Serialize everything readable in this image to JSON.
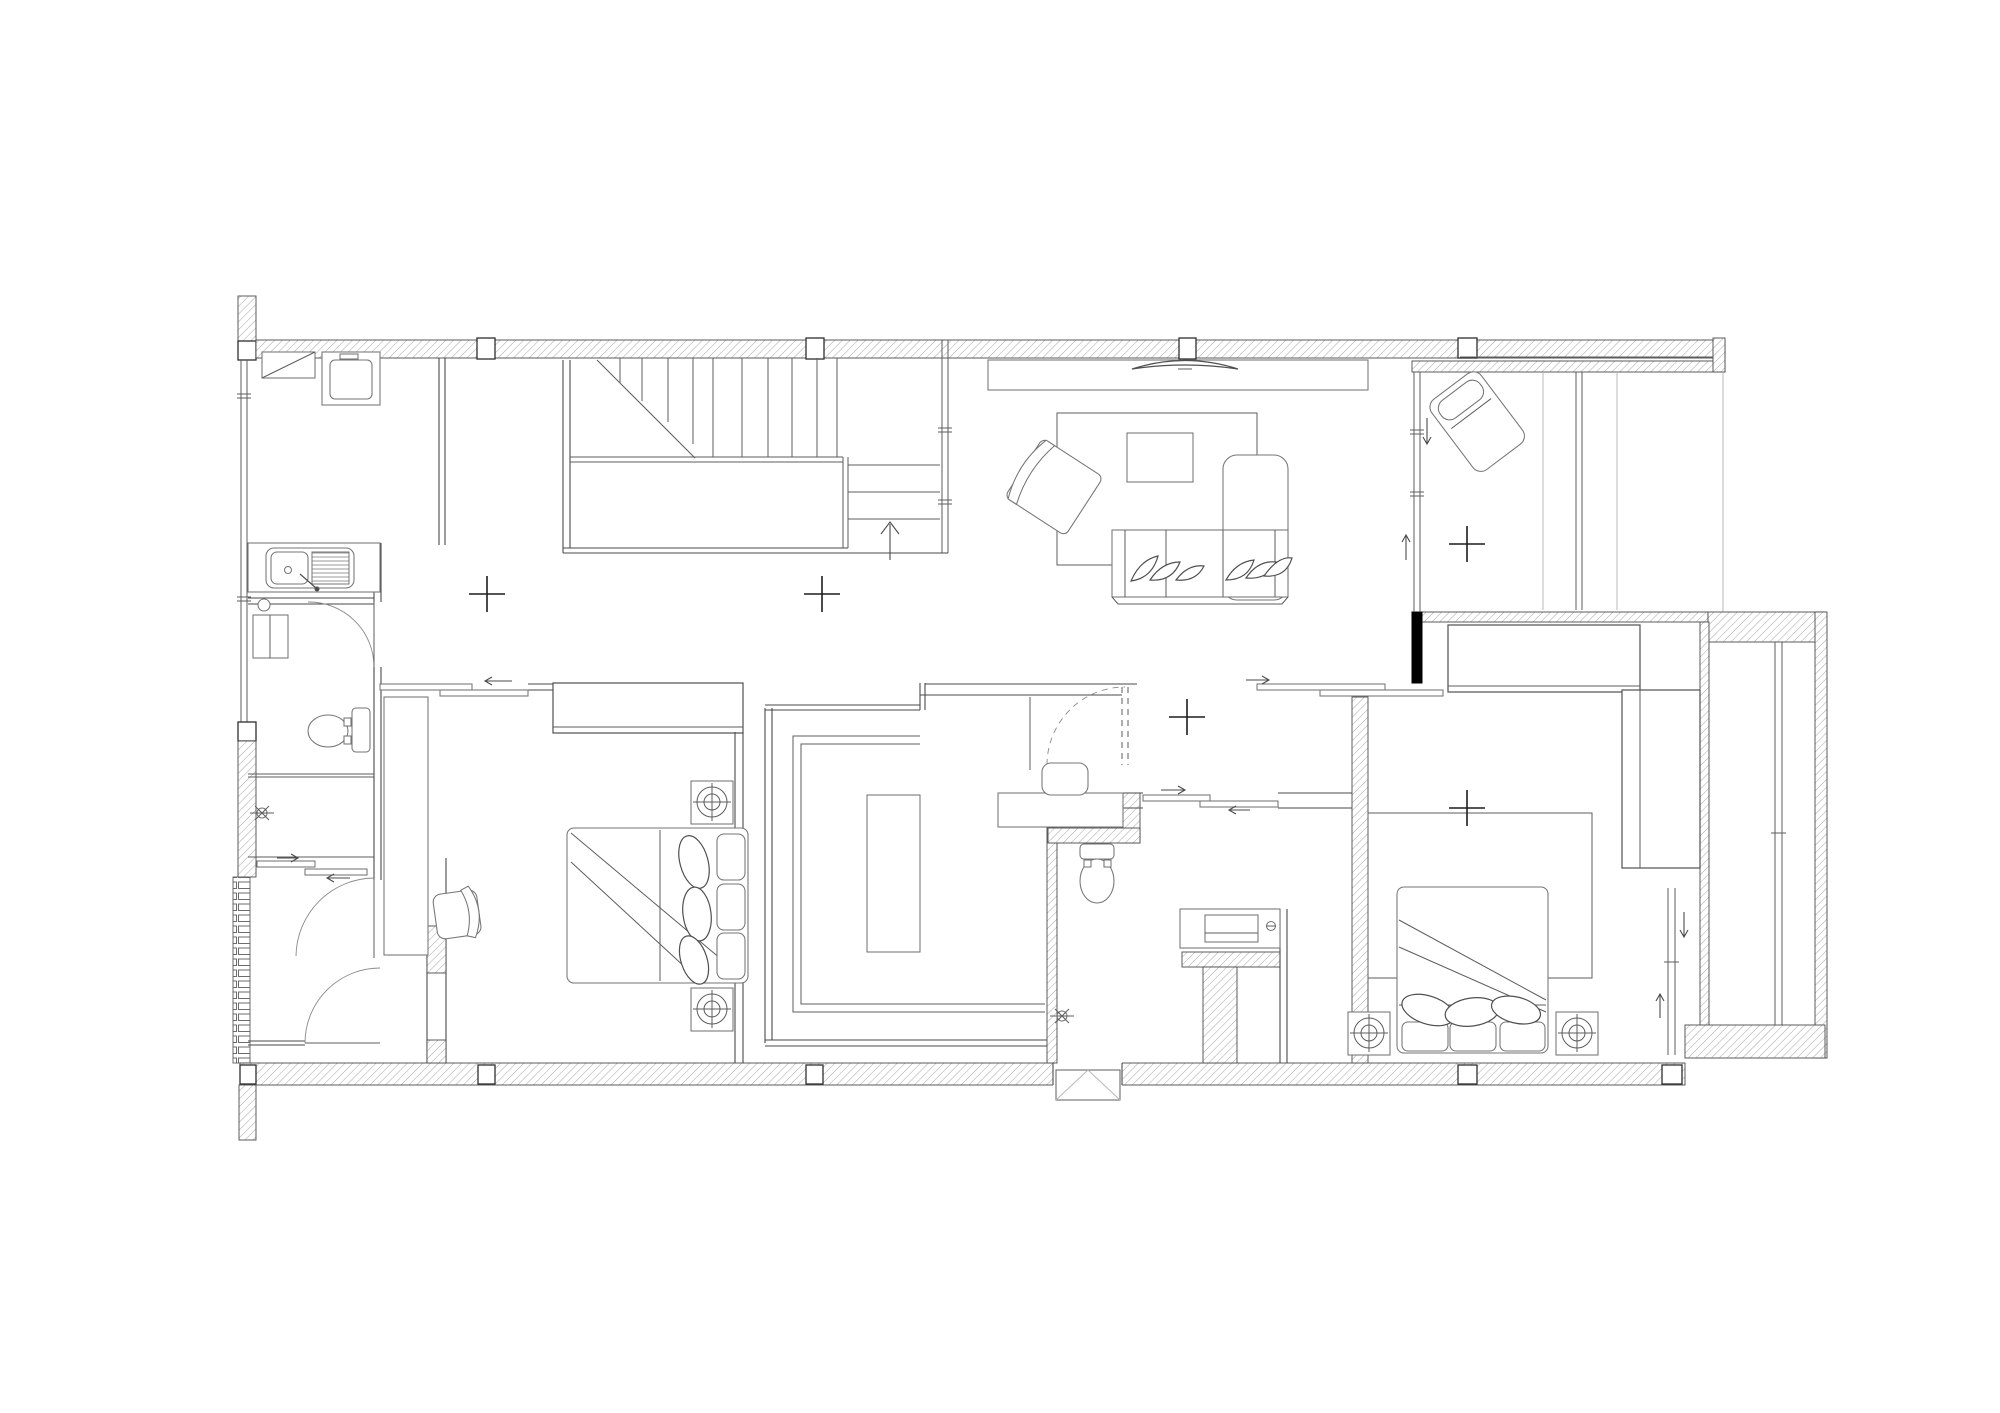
{
  "document": {
    "kind": "architectural-floor-plan",
    "view": "top-down CAD drawing, black lines on white, no text labels",
    "page_label": "Residential floor plan"
  },
  "colors": {
    "background": "#ffffff",
    "wall_line": "#4a4a4a",
    "hatch_line": "#a6a6a6",
    "furniture_line": "#757575",
    "solid_wall_fill": "#000000",
    "marker_line": "#1d1d1d",
    "light_guide_line": "#b9b9b9"
  },
  "symbols": {
    "wall_fill": "diagonal-hatch",
    "survey_cross_count": 5,
    "stair_direction": "up",
    "door_swing_arcs": 5,
    "sliding_doors": 4
  },
  "rooms": [
    {
      "id": "laundry",
      "label": "Laundry / kitchenette",
      "fixtures": [
        "counter-with-shelf",
        "washing-machine",
        "double-sink-counter"
      ]
    },
    {
      "id": "bathroom-1",
      "label": "Bathroom 1",
      "fixtures": [
        "wall-basin",
        "toilet",
        "shower-head",
        "sliding-entry-door"
      ]
    },
    {
      "id": "stair-hall",
      "label": "Staircase hall",
      "fixtures": [
        "u-shaped-stair",
        "up-arrow",
        "landing"
      ]
    },
    {
      "id": "living-room",
      "label": "Living room",
      "fixtures": [
        "tv-console",
        "tv",
        "rug",
        "coffee-table",
        "armchair",
        "l-shaped-sofa"
      ]
    },
    {
      "id": "terrace",
      "label": "Terrace",
      "fixtures": [
        "lounge-chair",
        "deck-lines",
        "full-height-glazing"
      ]
    },
    {
      "id": "bedroom-1",
      "label": "Bedroom 1",
      "fixtures": [
        "wardrobe",
        "desk",
        "desk-chair",
        "double-bed",
        "nightstand-downlight",
        "nightstand-downlight"
      ]
    },
    {
      "id": "walk-in-closet",
      "label": "Walk-in closet",
      "fixtures": [
        "u-shaped-wardrobe",
        "island-dresser"
      ]
    },
    {
      "id": "vestibule",
      "label": "Dressing vestibule",
      "fixtures": [
        "wash-basin-counter"
      ]
    },
    {
      "id": "bathroom-2",
      "label": "Bathroom 2",
      "fixtures": [
        "toilet",
        "vanity-sink",
        "shower-head",
        "sliding-door"
      ]
    },
    {
      "id": "bedroom-2",
      "label": "Bedroom 2",
      "fixtures": [
        "wardrobe",
        "rug",
        "double-bed",
        "nightstand-downlight",
        "nightstand-downlight",
        "window-to-lightwell"
      ]
    },
    {
      "id": "light-well",
      "label": "Light well / rear balcony",
      "fixtures": [
        "glазing-line"
      ]
    },
    {
      "id": "entry-vestibule",
      "label": "Entry vestibule",
      "fixtures": [
        "swing-door",
        "swing-door",
        "louvered-wall"
      ]
    }
  ]
}
